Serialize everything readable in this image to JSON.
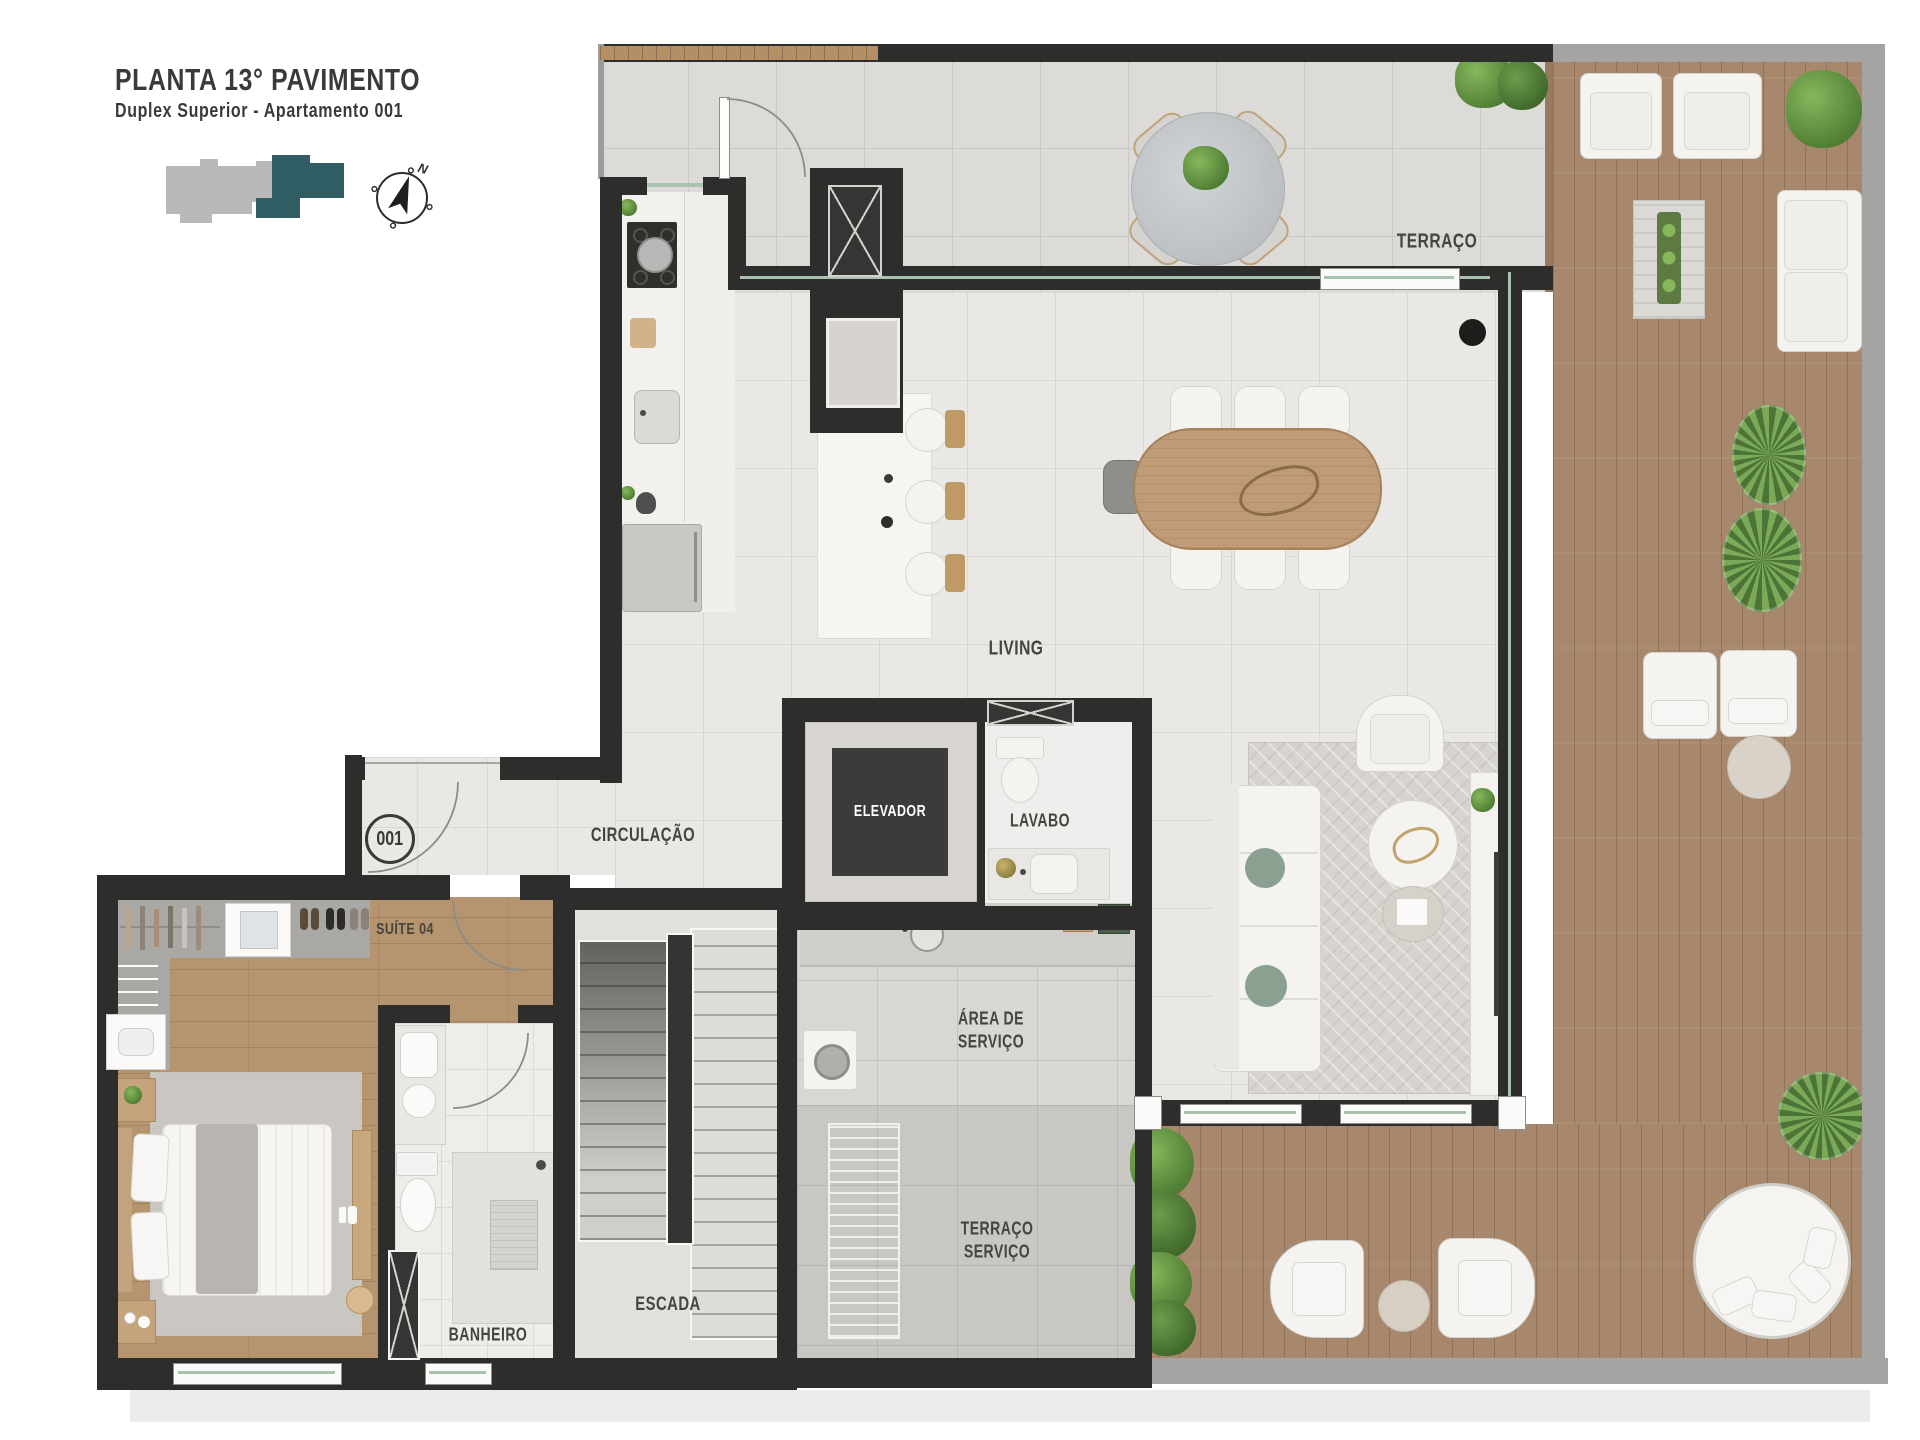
{
  "header": {
    "title": "PLANTA 13° PAVIMENTO",
    "subtitle": "Duplex Superior - Apartamento 001"
  },
  "compass": {
    "north_label": "N"
  },
  "unit": {
    "number": "001"
  },
  "rooms": {
    "terraco": {
      "label": "TERRAÇO"
    },
    "living": {
      "label": "LIVING"
    },
    "circulacao": {
      "label": "CIRCULAÇÃO"
    },
    "elevador": {
      "label": "ELEVADOR"
    },
    "lavabo": {
      "label": "LAVABO"
    },
    "suite04": {
      "label": "SUÍTE 04"
    },
    "banheiro": {
      "label": "BANHEIRO"
    },
    "escada": {
      "label": "ESCADA"
    },
    "area_servico": {
      "line1": "ÁREA DE",
      "line2": "SERVIÇO"
    },
    "terraco_servico": {
      "line1": "TERRAÇO",
      "line2": "SERVIÇO"
    }
  },
  "colors": {
    "wall": "#2d2d2b",
    "interior_tile": "#e9e8e5",
    "outdoor_tile": "#dcdbd7",
    "wood_deck": "#a8886c",
    "wood_floor": "#b5946f",
    "keymap_building": "#b9b9b9",
    "keymap_highlight": "#2f5d63",
    "label_text": "#45443f",
    "elevator_text": "#ffffff"
  }
}
